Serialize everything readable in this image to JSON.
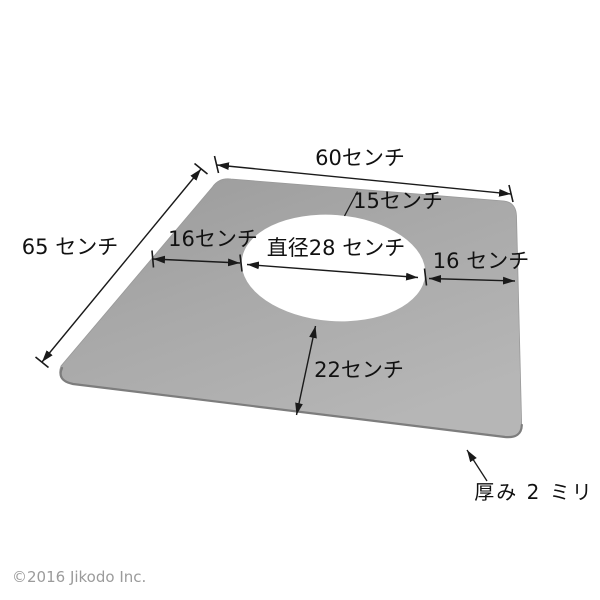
{
  "diagram": {
    "type": "product-dimension-diagram",
    "subject": "flat plate with round center hole, perspective view",
    "dimensions": {
      "top_width": "60センチ",
      "left_height": "65 センチ",
      "hole_top_offset": "15センチ",
      "hole_left_offset": "16センチ",
      "hole_diameter": "直径28 センチ",
      "hole_right_offset": "16 センチ",
      "hole_bottom_offset": "22センチ",
      "thickness": "厚み 2 ミリ"
    },
    "colors": {
      "background": "#ffffff",
      "plate_top": "#9a9a9a",
      "plate_mid": "#a8a8a8",
      "plate_bottom": "#b6b6b6",
      "plate_edge": "#7d7d7d",
      "hole_fill": "#ffffff",
      "line": "#1a1a1a",
      "copyright_text": "#9b9b9b"
    }
  },
  "footer": {
    "copyright": "©2016 Jikodo Inc."
  }
}
